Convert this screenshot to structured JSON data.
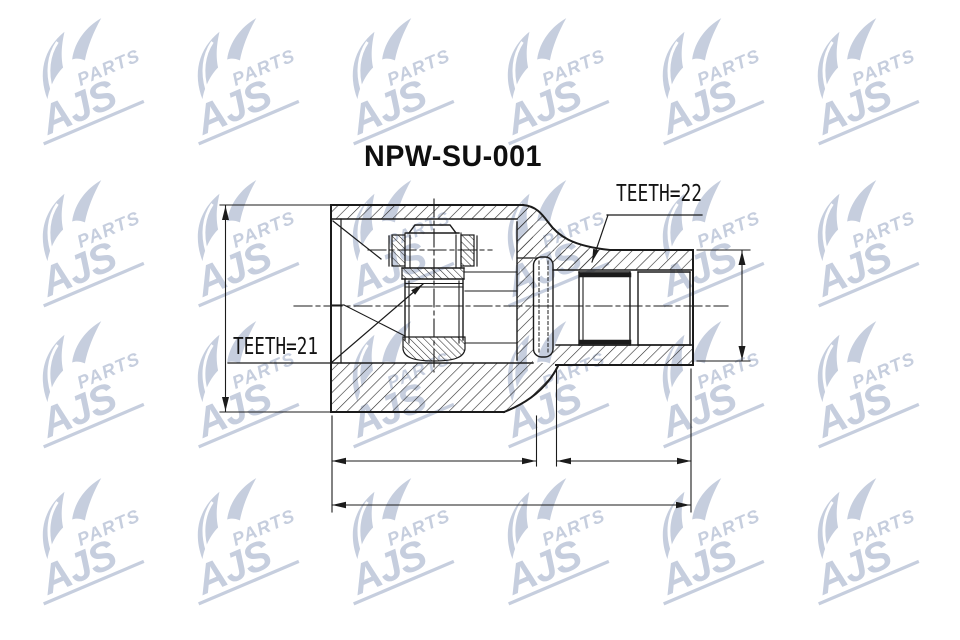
{
  "page": {
    "background": "#ffffff"
  },
  "drawing": {
    "part_number": "NPW-SU-001",
    "labels": {
      "teeth_right": "TEETH=22",
      "teeth_left": "TEETH=21"
    },
    "line_color": "#1b1b1b"
  },
  "watermark": {
    "word_main": "AJS",
    "word_sub": "PARTS",
    "color": "#c6cede"
  }
}
